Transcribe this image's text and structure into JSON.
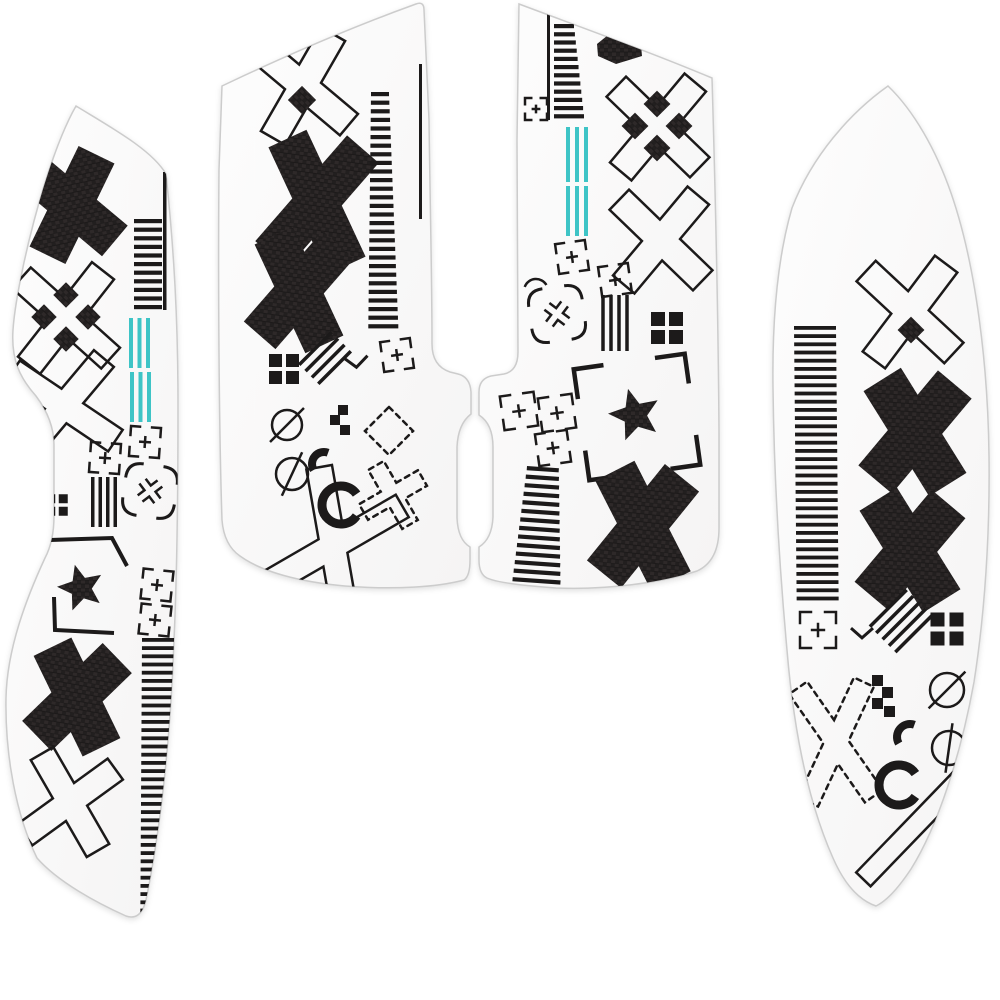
{
  "meta": {
    "alt": "White mouse grip tape sticker set, four die-cut pieces decorated with black X-pattern geometric print and teal accent lines"
  },
  "colors": {
    "background": "#ffffff",
    "piece_fill_light": "#fdfdfd",
    "piece_fill_dark": "#f5f4f4",
    "piece_border": "#cccccc",
    "ink": "#1c1a1a",
    "carbon": "#221f1f",
    "carbon_weave": "#2e2929",
    "carbon_dark": "#181616",
    "teal": "#3ec4c6"
  },
  "pieces": [
    {
      "id": "left-side-grip",
      "outline": "M 76 106 C 112 128 152 150 166 174 C 174 250 178 320 178 405 C 178 495 177 575 174 640 C 171 728 162 822 146 900 Q 141 921 126 916 C 97 903 58 882 37 858 C 16 815 5 755 6 698 C 7 648 27 597 45 558 Q 54 541 54 516 L 54 445 Q 54 420 36 396 C 20 378 11 360 13 330 C 16 284 45 160 76 106 Z",
      "motifs": [
        {
          "t": "solidX",
          "cx": 72,
          "cy": 205,
          "h": 56,
          "w": 20,
          "a": 38,
          "rot": -12
        },
        {
          "t": "thinline",
          "x": 163,
          "y": 172,
          "w": 3.5,
          "len": 138
        },
        {
          "t": "stripes",
          "x": 134,
          "y": 219,
          "n": 11,
          "p": 8.6,
          "bh": 4.2,
          "w0": 28,
          "w1": 28,
          "tilt": 0
        },
        {
          "t": "outlineX",
          "cx": 66,
          "cy": 318,
          "h": 60,
          "w": 14,
          "a": 43,
          "rot": -5
        },
        {
          "t": "diamondCluster",
          "cx": 66,
          "cy": 317,
          "s": 18,
          "off": 22
        },
        {
          "t": "outlineX",
          "cx": 64,
          "cy": 406,
          "h": 62,
          "w": 13,
          "a": 48,
          "rot": -8
        },
        {
          "t": "lines3",
          "x": 129,
          "y": 318,
          "n": 3,
          "gap": 8.5,
          "w": 4,
          "len": 50,
          "c": "teal"
        },
        {
          "t": "lines3",
          "x": 130,
          "y": 372,
          "n": 3,
          "gap": 8.5,
          "w": 4,
          "len": 50,
          "c": "teal"
        },
        {
          "t": "bracketPlus",
          "cx": 145,
          "cy": 442,
          "s": 30,
          "rot": 4
        },
        {
          "t": "bracketPlus",
          "cx": 105,
          "cy": 458,
          "s": 30,
          "rot": 4
        },
        {
          "t": "brokenX",
          "cx": 150,
          "cy": 491,
          "s": 26,
          "rot": 8
        },
        {
          "t": "hatch",
          "cx": 104,
          "cy": 502,
          "len": 50,
          "n": 4,
          "gap": 7.5,
          "rot": 0
        },
        {
          "t": "checker",
          "cx": 57,
          "cy": 505,
          "cell": 9,
          "gap": 3.5
        },
        {
          "t": "polyline",
          "pts": [
            [
              50,
              540
            ],
            [
              112,
              538
            ],
            [
              127,
              566
            ]
          ],
          "sw": 4
        },
        {
          "t": "star",
          "cx": 81,
          "cy": 588,
          "r": 24,
          "rot": -15
        },
        {
          "t": "bracketPlus",
          "cx": 157,
          "cy": 585,
          "s": 30,
          "rot": 6
        },
        {
          "t": "bracketPlus",
          "cx": 155,
          "cy": 620,
          "s": 30,
          "rot": 6
        },
        {
          "t": "polyline",
          "pts": [
            [
              54,
              597
            ],
            [
              55,
              630
            ],
            [
              114,
              633
            ]
          ],
          "sw": 4
        },
        {
          "t": "stripes",
          "x": 142,
          "y": 638,
          "n": 36,
          "p": 8.2,
          "bh": 3.8,
          "w0": 33,
          "w1": 33,
          "tilt": -0.05
        },
        {
          "t": "solidX",
          "cx": 77,
          "cy": 697,
          "h": 56,
          "w": 21,
          "a": 36,
          "rot": 10
        },
        {
          "t": "outlineX",
          "cx": 70,
          "cy": 802,
          "h": 56,
          "w": 13,
          "a": 42,
          "rot": 12
        }
      ]
    },
    {
      "id": "left-main-button",
      "outline": "M 222 86 C 285 56 355 26 416 4 Q 424 1 424 10 L 429 120 C 430 200 432 280 432 344 Q 432 366 450 372 L 458 374 Q 470 377 471 392 L 471 414 Q 458 424 457 447 L 457 518 Q 458 540 470 547 L 470 560 Q 470 576 464 580 C 438 587 395 590 345 586 C 300 582 262 572 240 556 Q 224 545 222 520 C 219 430 218 280 219 170 L 222 86 Z",
      "motifs": [
        {
          "t": "outlineX",
          "cx": 303,
          "cy": 86,
          "h": 60,
          "w": 14,
          "a": 40,
          "rot": -10
        },
        {
          "t": "diamond",
          "cx": 302,
          "cy": 100,
          "s": 20
        },
        {
          "t": "solidX",
          "cx": 317,
          "cy": 202,
          "h": 70,
          "w": 21,
          "a": 33,
          "rot": 8
        },
        {
          "t": "solidX",
          "cx": 299,
          "cy": 290,
          "h": 60,
          "w": 21,
          "a": 33,
          "rot": 8
        },
        {
          "t": "stripes",
          "x": 371,
          "y": 92,
          "n": 28,
          "p": 8.6,
          "bh": 4.2,
          "w0": 18,
          "w1": 30,
          "tilt": -0.1
        },
        {
          "t": "thinline",
          "x": 419,
          "y": 64,
          "w": 3,
          "len": 155
        },
        {
          "t": "bracketPlus",
          "cx": 397,
          "cy": 355,
          "s": 30,
          "rot": -8
        },
        {
          "t": "checker",
          "cx": 284,
          "cy": 369,
          "cell": 13,
          "gap": 4
        },
        {
          "t": "hatch",
          "cx": 325,
          "cy": 358,
          "len": 46,
          "n": 4,
          "gap": 9,
          "rot": 45
        },
        {
          "t": "chevron",
          "cx": 356,
          "cy": 362,
          "s": 24,
          "rot": -5
        },
        {
          "t": "circleSlash",
          "cx": 287,
          "cy": 425,
          "r": 15,
          "ang": 45,
          "over": 9
        },
        {
          "t": "circleSlash",
          "cx": 292,
          "cy": 474,
          "r": 16,
          "ang": 25,
          "over": 8
        },
        {
          "t": "pixels",
          "pts": [
            [
              338,
              405
            ],
            [
              330,
              415
            ],
            [
              340,
              425
            ]
          ],
          "s": 10
        },
        {
          "t": "dashedDiamond",
          "cx": 389,
          "cy": 431,
          "s": 34,
          "rot": 0
        },
        {
          "t": "dashedX",
          "cx": 393,
          "cy": 495,
          "h": 34,
          "w": 9,
          "a": 45,
          "rot": 15
        },
        {
          "t": "arc",
          "cx": 324,
          "cy": 464,
          "r": 12,
          "sw": 8,
          "a0": 150,
          "a1": 290
        },
        {
          "t": "arc",
          "cx": 341,
          "cy": 505,
          "r": 19,
          "sw": 9,
          "a0": 35,
          "a1": 325
        },
        {
          "t": "outlineX",
          "cx": 333,
          "cy": 546,
          "h": 80,
          "w": 13,
          "a": 35,
          "rot": 25
        }
      ]
    },
    {
      "id": "right-main-button",
      "outline": "M 519 4 C 583 28 650 52 712 78 C 715 180 718 300 719 430 L 719 528 Q 719 561 697 571 C 660 583 606 590 556 588 C 527 586 498 583 487 578 Q 479 574 479 560 L 479 547 Q 492 539 493 517 L 493 447 Q 493 424 479 415 L 479 392 Q 479 379 491 376 L 504 374 Q 518 371 518 352 L 517 140 L 519 4 Z",
      "motifs": [
        {
          "t": "thinline",
          "x": 547,
          "y": 8,
          "w": 3,
          "len": 112
        },
        {
          "t": "stripes",
          "x": 554,
          "y": 24,
          "n": 12,
          "p": 8.2,
          "bh": 4.2,
          "w0": 20,
          "w1": 30,
          "tilt": 0
        },
        {
          "t": "bracketPlus",
          "cx": 536,
          "cy": 109,
          "s": 22,
          "rot": 0
        },
        {
          "t": "polygon",
          "pts": [
            [
              597,
              44
            ],
            [
              613,
              31
            ],
            [
              640,
              35
            ],
            [
              642,
              56
            ],
            [
              616,
              64
            ],
            [
              598,
              56
            ]
          ],
          "fill": "carbon"
        },
        {
          "t": "outlineX",
          "cx": 658,
          "cy": 127,
          "h": 58,
          "w": 14,
          "a": 43,
          "rot": -3
        },
        {
          "t": "diamondCluster",
          "cx": 657,
          "cy": 126,
          "s": 19,
          "off": 22
        },
        {
          "t": "lines3",
          "x": 566,
          "y": 127,
          "n": 3,
          "gap": 9,
          "w": 4,
          "len": 55,
          "c": "teal"
        },
        {
          "t": "lines3",
          "x": 566,
          "y": 186,
          "n": 3,
          "gap": 9,
          "w": 4,
          "len": 50,
          "c": "teal"
        },
        {
          "t": "outlineX",
          "cx": 661,
          "cy": 240,
          "h": 58,
          "w": 14,
          "a": 43,
          "rot": -3
        },
        {
          "t": "bracketPlus",
          "cx": 572,
          "cy": 257,
          "s": 30,
          "rot": -8
        },
        {
          "t": "bracketPlus",
          "cx": 615,
          "cy": 280,
          "s": 30,
          "rot": -8
        },
        {
          "t": "arc",
          "cx": 536,
          "cy": 291,
          "r": 12,
          "sw": 2.5,
          "a0": 200,
          "a1": 330
        },
        {
          "t": "brokenX",
          "cx": 557,
          "cy": 314,
          "s": 27,
          "rot": -8
        },
        {
          "t": "hatch",
          "cx": 615,
          "cy": 323,
          "len": 56,
          "n": 4,
          "gap": 8,
          "rot": 0
        },
        {
          "t": "checker",
          "cx": 667,
          "cy": 328,
          "cell": 14,
          "gap": 4
        },
        {
          "t": "cornerFrame",
          "cx": 637,
          "cy": 417,
          "s": 112,
          "arm": 30,
          "rot": -8,
          "sw": 4.5
        },
        {
          "t": "star",
          "cx": 635,
          "cy": 415,
          "r": 27,
          "rot": -15
        },
        {
          "t": "bracketPlus",
          "cx": 519,
          "cy": 411,
          "s": 34,
          "rot": -8
        },
        {
          "t": "bracketPlus",
          "cx": 557,
          "cy": 413,
          "s": 34,
          "rot": -8
        },
        {
          "t": "bracketPlus",
          "cx": 553,
          "cy": 448,
          "s": 32,
          "rot": -8
        },
        {
          "t": "stripes",
          "x": 527,
          "y": 466,
          "n": 14,
          "p": 8.6,
          "bh": 4.2,
          "w0": 32,
          "w1": 48,
          "tilt": -0.5,
          "rot": 4
        },
        {
          "t": "solidX",
          "cx": 643,
          "cy": 526,
          "h": 62,
          "w": 22,
          "a": 33,
          "rot": 6
        }
      ]
    },
    {
      "id": "right-side-grip",
      "outline": "M 888 86 C 850 113 812 156 792 208 C 778 256 772 316 773 388 C 774 472 779 562 787 650 C 794 734 809 804 833 858 Q 850 897 876 906 Q 891 899 911 869 C 938 826 961 754 974 682 C 985 612 990 532 989 456 C 988 370 977 268 951 193 C 936 150 914 111 888 86 Z",
      "motifs": [
        {
          "t": "outlineX",
          "cx": 910,
          "cy": 312,
          "h": 60,
          "w": 14,
          "a": 42,
          "rot": -5
        },
        {
          "t": "diamond",
          "cx": 911,
          "cy": 330,
          "s": 19
        },
        {
          "t": "stripes",
          "x": 794,
          "y": 326,
          "n": 34,
          "p": 8.2,
          "bh": 3.8,
          "w0": 42,
          "w1": 42,
          "tilt": 0.08
        },
        {
          "t": "solidX",
          "cx": 915,
          "cy": 432,
          "h": 62,
          "w": 22,
          "a": 36,
          "rot": 4
        },
        {
          "t": "solidX",
          "cx": 910,
          "cy": 550,
          "h": 60,
          "w": 22,
          "a": 36,
          "rot": 4
        },
        {
          "t": "bracketPlus",
          "cx": 818,
          "cy": 630,
          "s": 36,
          "rot": 0
        },
        {
          "t": "chevron",
          "cx": 862,
          "cy": 633,
          "s": 22,
          "rot": 0
        },
        {
          "t": "hatch",
          "cx": 901,
          "cy": 621,
          "len": 52,
          "n": 5,
          "gap": 9,
          "rot": 45
        },
        {
          "t": "checker",
          "cx": 947,
          "cy": 629,
          "cell": 14,
          "gap": 5
        },
        {
          "t": "dashedX",
          "cx": 836,
          "cy": 742,
          "h": 66,
          "w": 11,
          "a": 30,
          "rot": -5
        },
        {
          "t": "pixels",
          "pts": [
            [
              872,
              675
            ],
            [
              882,
              687
            ],
            [
              872,
              698
            ],
            [
              884,
              706
            ]
          ],
          "s": 11
        },
        {
          "t": "circleSlash",
          "cx": 947,
          "cy": 690,
          "r": 17,
          "ang": 45,
          "over": 9
        },
        {
          "t": "arc",
          "cx": 910,
          "cy": 737,
          "r": 13,
          "sw": 8,
          "a0": 150,
          "a1": 290
        },
        {
          "t": "circleSlash",
          "cx": 949,
          "cy": 748,
          "r": 17,
          "ang": 8,
          "over": 8
        },
        {
          "t": "arc",
          "cx": 899,
          "cy": 785,
          "r": 20,
          "sw": 9,
          "a0": 35,
          "a1": 325
        },
        {
          "t": "outlineBar",
          "cx": 912,
          "cy": 829,
          "len": 140,
          "w": 20,
          "rot": -46
        }
      ]
    }
  ]
}
